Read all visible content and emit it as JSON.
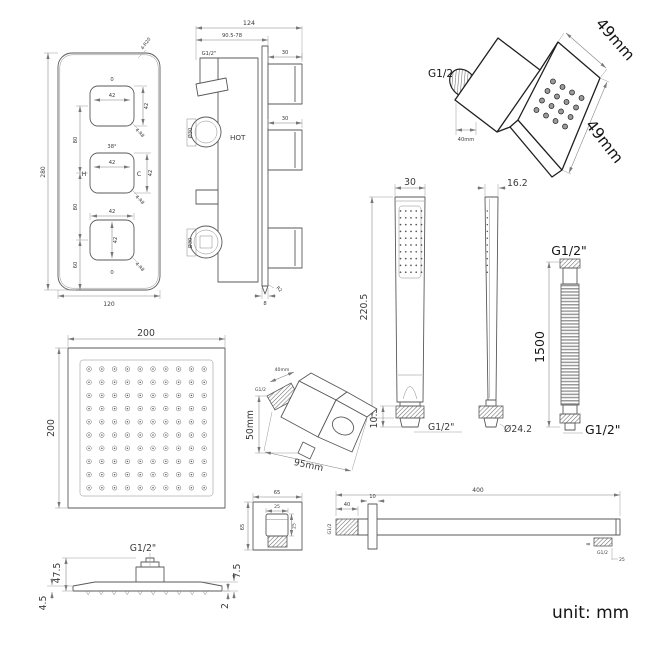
{
  "unit_note": "unit: mm",
  "valve_front": {
    "height_total": "280",
    "width_total": "120",
    "spacing_top": "80",
    "spacing_mid": "80",
    "spacing_bottom": "60",
    "corner_callout": "4-R20",
    "knobs": [
      {
        "above": "0",
        "w": "42",
        "h": "42",
        "corner": "4-R8"
      },
      {
        "above": "38°",
        "w": "42",
        "h": "42",
        "left": "H",
        "right": "C",
        "corner": "4-R8"
      },
      {
        "above": "42",
        "h": "42",
        "below": "0",
        "corner": "4-R8"
      }
    ]
  },
  "valve_side": {
    "width_total": "124",
    "depth_range": "90.5-78",
    "inlet_thread": "G1/2\"",
    "hot_label": "HOT",
    "stem_len_top": "30",
    "stem_len_mid": "30",
    "knob_dia_top": "Ø30",
    "knob_dia_bottom": "Ø30",
    "plate_thickness": "8",
    "plate_corner": "R2"
  },
  "body_jet": {
    "thread": "G1/2",
    "depth": "40mm",
    "face_width": "49mm",
    "face_height": "49mm",
    "nozzle_grid": {
      "rows": 4,
      "cols": 4
    }
  },
  "hand_shower": {
    "width": "30",
    "length": "220.5",
    "outlet_length": "10.5",
    "thread": "G1/2\"",
    "face_grid": {
      "rows": 10,
      "cols": 5
    }
  },
  "hand_shower_side": {
    "width": "16.2",
    "collar_dia": "Ø24.2",
    "face_grid": {
      "rows": 10,
      "cols": 1
    }
  },
  "hose": {
    "top_thread": "G1/2\"",
    "length": "1500",
    "bottom_thread": "G1/2\""
  },
  "head_top": {
    "width": "200",
    "depth": "200",
    "nozzle_grid": {
      "rows": 10,
      "cols": 10
    }
  },
  "head_side": {
    "thread": "G1/2\"",
    "height": "47.5",
    "edge_thickness": "4.5",
    "body_thickness": "7.5",
    "lip": "2"
  },
  "elbow": {
    "thread_length": "40mm",
    "thread": "G1/2",
    "height": "50mm",
    "width": "95mm"
  },
  "wall_plate": {
    "width": "65",
    "height": "65",
    "knob_width": "25",
    "knob_height": "25"
  },
  "arm": {
    "length": "400",
    "thread_length": "40",
    "flange_thickness": "10",
    "thread": "G1/2",
    "tip_mark": "8",
    "tip_thread": "G1/2",
    "tip_length": "25"
  }
}
